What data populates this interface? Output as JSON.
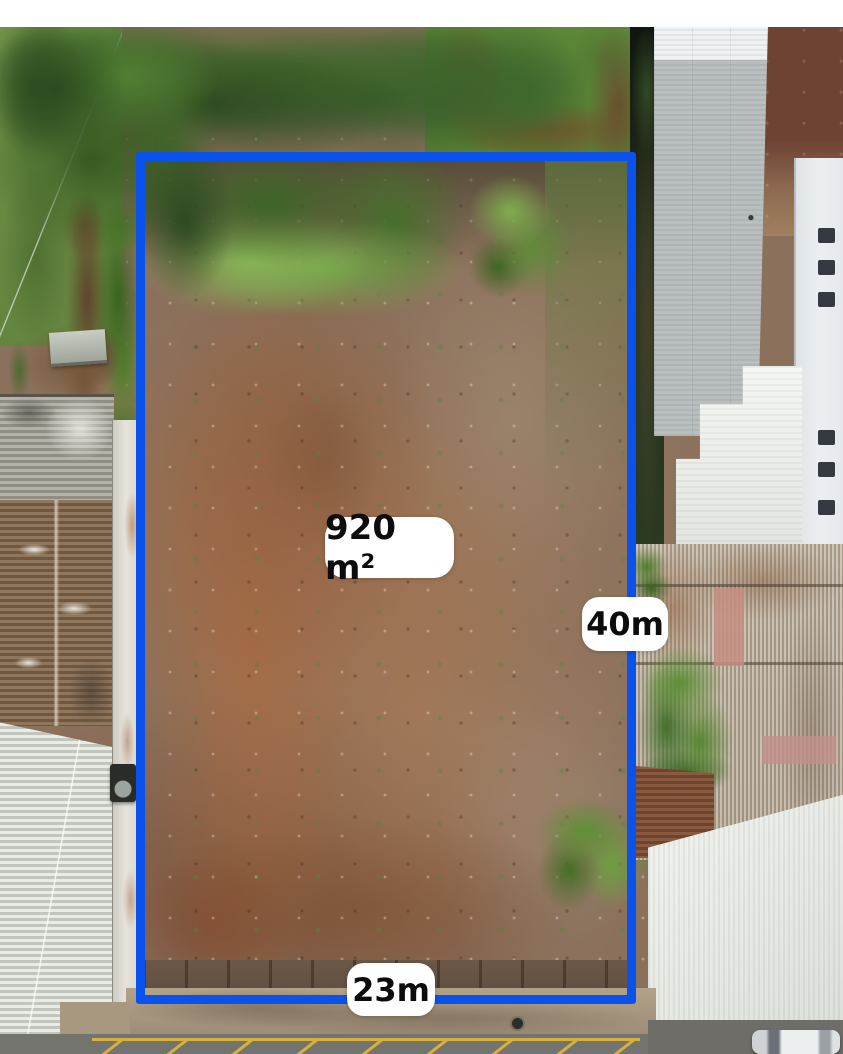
{
  "photo": {
    "overlay": {
      "area_text": "920 m²",
      "right_side_text": "40m",
      "bottom_side_text": "23m"
    },
    "colors": {
      "boundary_blue": "#0b51ec",
      "label_background": "#ffffff",
      "label_text": "#0c0c0c"
    }
  }
}
